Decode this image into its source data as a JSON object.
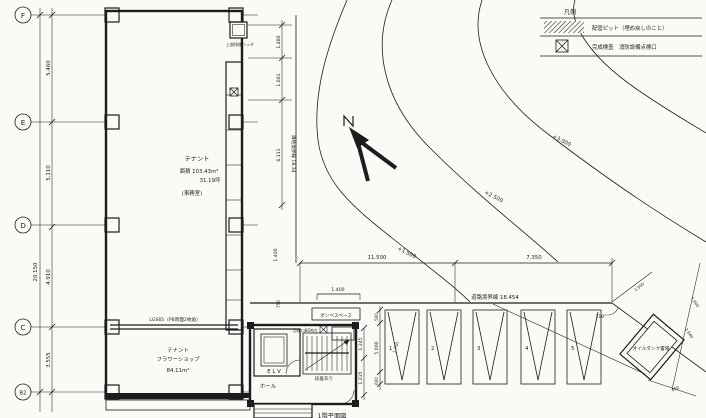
{
  "sheet": {
    "title_partial": "1階平面図"
  },
  "legend": {
    "title": "凡例",
    "row1_label": "配管ピット（埋め戻しのこと）",
    "row2_label": "完成検査　消防設備点検口"
  },
  "grid": {
    "f": "F",
    "e": "E",
    "d": "D",
    "c": "C",
    "b2": "B2"
  },
  "dims_left": {
    "total": "20.150",
    "f_e": "5.460",
    "e_d": "5.110",
    "d_c": "4.910",
    "c_b2": "3.555"
  },
  "dims_right": {
    "d1": "1.480",
    "d2": "1.661",
    "d3": "6.111",
    "boundary": "隣地境界線 18.34"
  },
  "tenant_upper": {
    "name": "テナント",
    "area": "面積 103.43m²",
    "tsubo": "31.19坪",
    "use": "(事務室)"
  },
  "partition": {
    "label": "LGS65（PB両面2枚貼）"
  },
  "tenant_lower": {
    "name": "テナント",
    "shop": "フラワーショップ",
    "area": "84.11m²"
  },
  "roof_hatch": {
    "label": "上部排煙ハッチ"
  },
  "core": {
    "elevator": "E L V",
    "hall": "ホール",
    "stair_note": "段差あり",
    "inspection_note": "点検口BOX内",
    "dim1": "1.345",
    "dim2": "1.235",
    "bombe": "ボンベスペース"
  },
  "site": {
    "dim_w1": "11.500",
    "dim_w2": "7.350",
    "dim_small": "1.400",
    "dim_small2": "1.400",
    "dim_small3": "750",
    "road_boundary": "道路境界線 18.454",
    "contour1": "+1.500",
    "contour2": "+2.500",
    "contour3": "+3.000",
    "angle": "110°"
  },
  "parking": {
    "n1": "1",
    "n2": "2",
    "n3": "3",
    "n4": "4",
    "n5": "5",
    "dim_top": "500",
    "dim_depth": "5.000",
    "dim_bottom": "600",
    "dim_width": "1.750"
  },
  "oil_tank": {
    "label": "オイルタンク置場",
    "d1": "1.500",
    "d2": "1.600",
    "d3": "2.640",
    "d4": "850"
  }
}
